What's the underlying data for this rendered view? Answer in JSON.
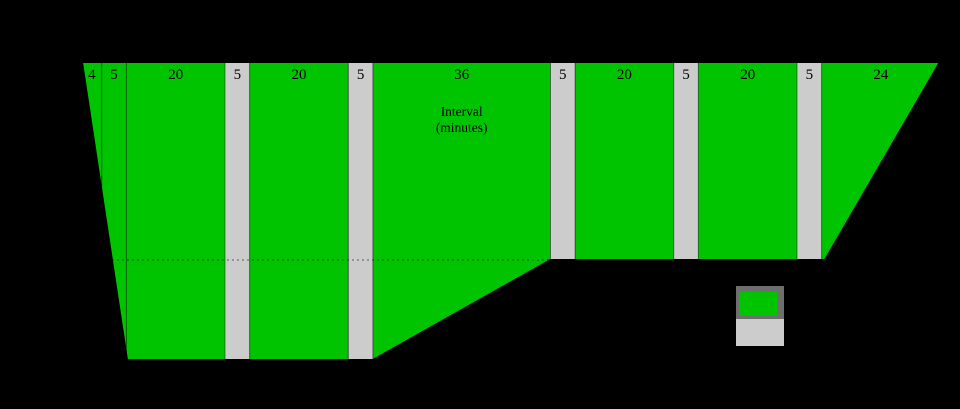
{
  "chart_data": {
    "type": "bar",
    "annotation": {
      "line1": "Interval",
      "line2": "(minutes)"
    },
    "segments": [
      {
        "label": "4",
        "minutes": 4,
        "color": "green"
      },
      {
        "label": "5",
        "minutes": 5,
        "color": "green"
      },
      {
        "label": "20",
        "minutes": 20,
        "color": "green"
      },
      {
        "label": "5",
        "minutes": 5,
        "color": "gray"
      },
      {
        "label": "20",
        "minutes": 20,
        "color": "green"
      },
      {
        "label": "5",
        "minutes": 5,
        "color": "gray"
      },
      {
        "label": "36",
        "minutes": 36,
        "color": "green"
      },
      {
        "label": "5",
        "minutes": 5,
        "color": "gray"
      },
      {
        "label": "20",
        "minutes": 20,
        "color": "green"
      },
      {
        "label": "5",
        "minutes": 5,
        "color": "gray"
      },
      {
        "label": "20",
        "minutes": 20,
        "color": "green"
      },
      {
        "label": "5",
        "minutes": 5,
        "color": "gray"
      },
      {
        "label": "24",
        "minutes": 24,
        "color": "green"
      }
    ],
    "total_minutes": 174,
    "colors": {
      "green": "#00c400",
      "gray": "#cccccc",
      "outline": "#000000",
      "legend_border": "#6e6e6e",
      "background": "#000000"
    },
    "legend": {
      "swatches": [
        {
          "name": "green-swatch",
          "color_key": "green"
        },
        {
          "name": "gray-swatch",
          "color_key": "gray"
        }
      ]
    }
  }
}
